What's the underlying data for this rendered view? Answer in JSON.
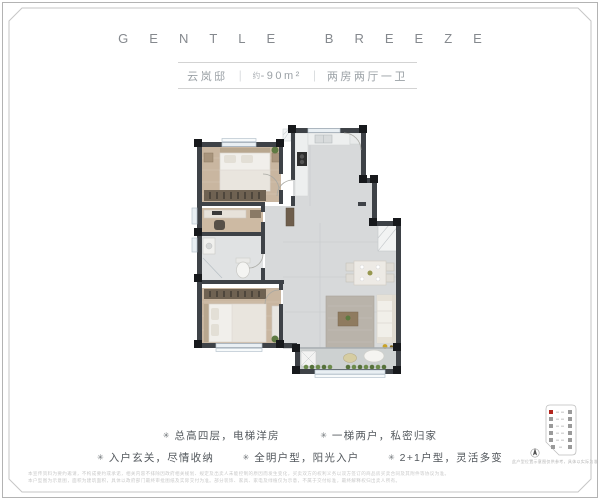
{
  "header": {
    "title": "GENTLE BREEZE"
  },
  "subtitle": {
    "name": "云岚邸",
    "separator": "｜",
    "area_prefix": "约",
    "area": "-90m²",
    "layout": "两房两厅一卫"
  },
  "features": {
    "bullet": "✳",
    "rows": [
      [
        "总高四层，电梯洋房",
        "一梯两户，私密归家"
      ],
      [
        "入户玄关，尽情收纳",
        "全明户型，阳光入户",
        "2+1户型，灵活多变"
      ]
    ]
  },
  "location_diagram": {
    "caption": "此户型位置示意图仅供参考，具体以实际为准",
    "floors": 6,
    "highlight_color": "#b3261e"
  },
  "disclaimer": {
    "line1": "本宣传资料为要约邀请，不构成要约或承诺，相关内容不排除因政府相关规划、规定及出卖人未能控制的原因而发生变化，买卖双方的权利义务以双方签订的商品房买卖合同及其附件等协议为准。",
    "line2": "本户型图为示意图，面积为建筑面积，具体以政府部门最终审批图纸及实际交付为准。部分装饰、家具、家电及绿植仅为示意，不属于交付标准，最终解释权归出卖人所有。"
  },
  "colors": {
    "wall": "#3e4247",
    "wood_floor": "#c9b6a0",
    "tile_floor": "#d7d9da",
    "accent_red": "#b3261e",
    "header_text": "#85898e"
  }
}
